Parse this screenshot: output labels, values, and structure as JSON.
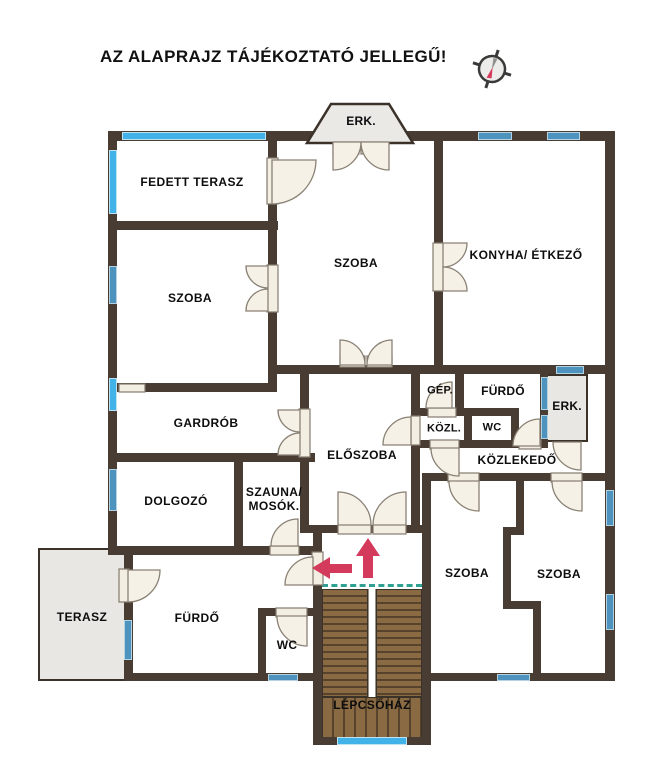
{
  "title": "AZ ALAPRAJZ TÁJÉKOZTATÓ JELLEGŰ!",
  "rooms": {
    "fedett_terasz": "FEDETT TERASZ",
    "szoba_top": "SZOBA",
    "konyha": "KONYHA/ ÉTKEZŐ",
    "erk_top": "ERK.",
    "szoba_left": "SZOBA",
    "gardrob": "GARDRÓB",
    "gep": "GÉP.",
    "furdo_upper": "FÜRDŐ",
    "erk_right": "ERK.",
    "kozl": "KÖZL.",
    "wc_upper": "WC",
    "eloszoba": "ELŐSZOBA",
    "kozlekedo": "KÖZLEKEDŐ",
    "dolgozo": "DOLGOZÓ",
    "szauna": "SZAUNA/\nMOSÓK.",
    "szoba_bottom_left": "SZOBA",
    "szoba_bottom_right": "SZOBA",
    "terasz": "TERASZ",
    "furdo_lower": "FÜRDŐ",
    "wc_lower": "WC",
    "lepcsohaz": "LÉPCSŐHÁZ"
  },
  "colors": {
    "wall": "#493c32",
    "window_cyan": "#41b3e8",
    "window_blue": "#4e93be",
    "door": "#f3eee2",
    "stair_wood": "#8a6a42",
    "arrow_red": "#d43a5c",
    "stair_dash_teal": "#2fa093",
    "outdoor_fill": "#e8e7e3"
  }
}
